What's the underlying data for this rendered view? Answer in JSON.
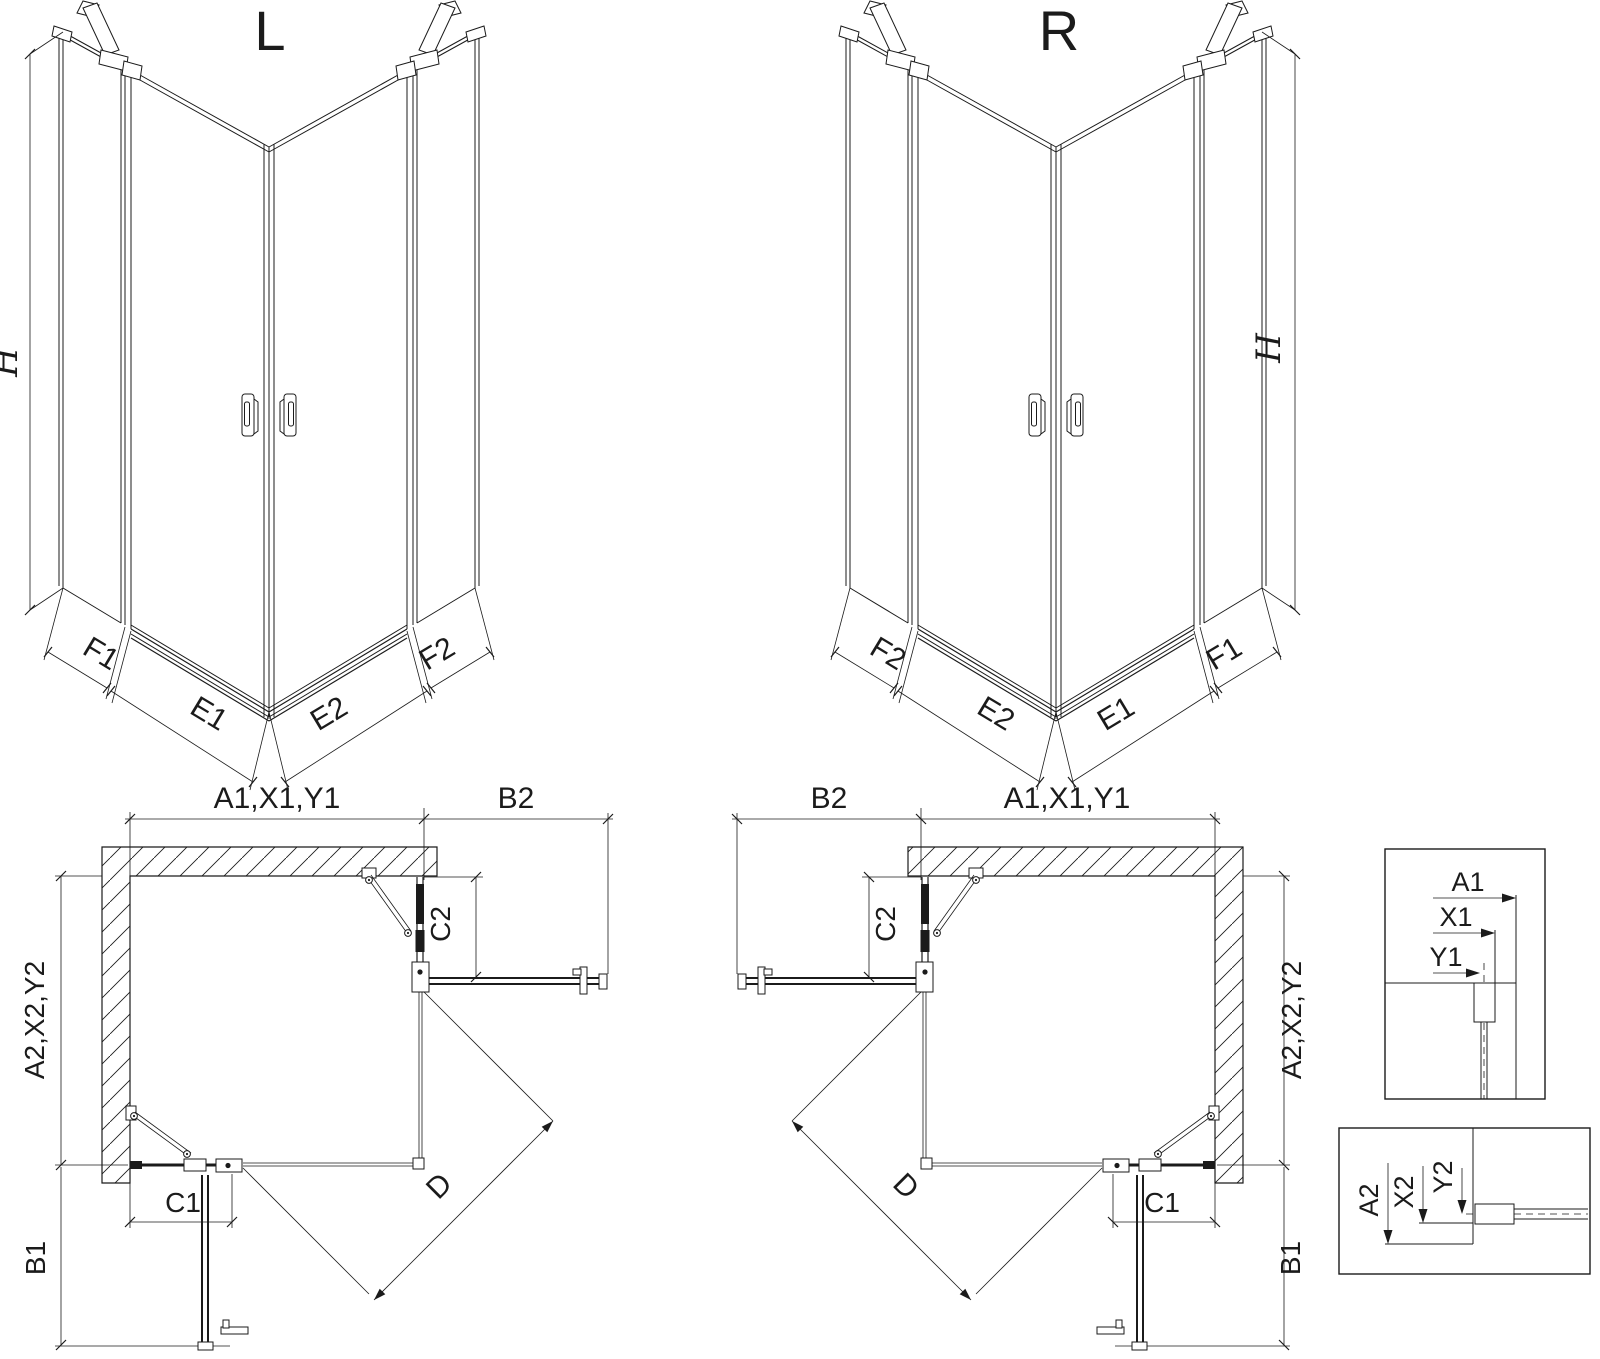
{
  "page": {
    "background": "#ffffff",
    "ink": "#1b1b1b"
  },
  "iso_left": {
    "title": "L",
    "height_label": "H",
    "segment_labels": [
      "F1",
      "E1",
      "E2",
      "F2"
    ]
  },
  "iso_right": {
    "title": "R",
    "height_label": "H",
    "segment_labels": [
      "F2",
      "E2",
      "E1",
      "F1"
    ]
  },
  "plan_left": {
    "width_top": "A1,X1,Y1",
    "width_top_outer": "B2",
    "height_side": "A2,X2,Y2",
    "depth_inner": "C2",
    "width_bottom": "C1",
    "height_bottom_outer": "B1",
    "diagonal": "D"
  },
  "plan_right": {
    "width_top": "A1,X1,Y1",
    "width_top_outer": "B2",
    "height_side": "A2,X2,Y2",
    "depth_inner": "C2",
    "width_bottom": "C1",
    "height_bottom_outer": "B1",
    "diagonal": "D"
  },
  "detail_width": {
    "labels": [
      "A1",
      "X1",
      "Y1"
    ]
  },
  "detail_height": {
    "labels": [
      "A2",
      "X2",
      "Y2"
    ]
  }
}
